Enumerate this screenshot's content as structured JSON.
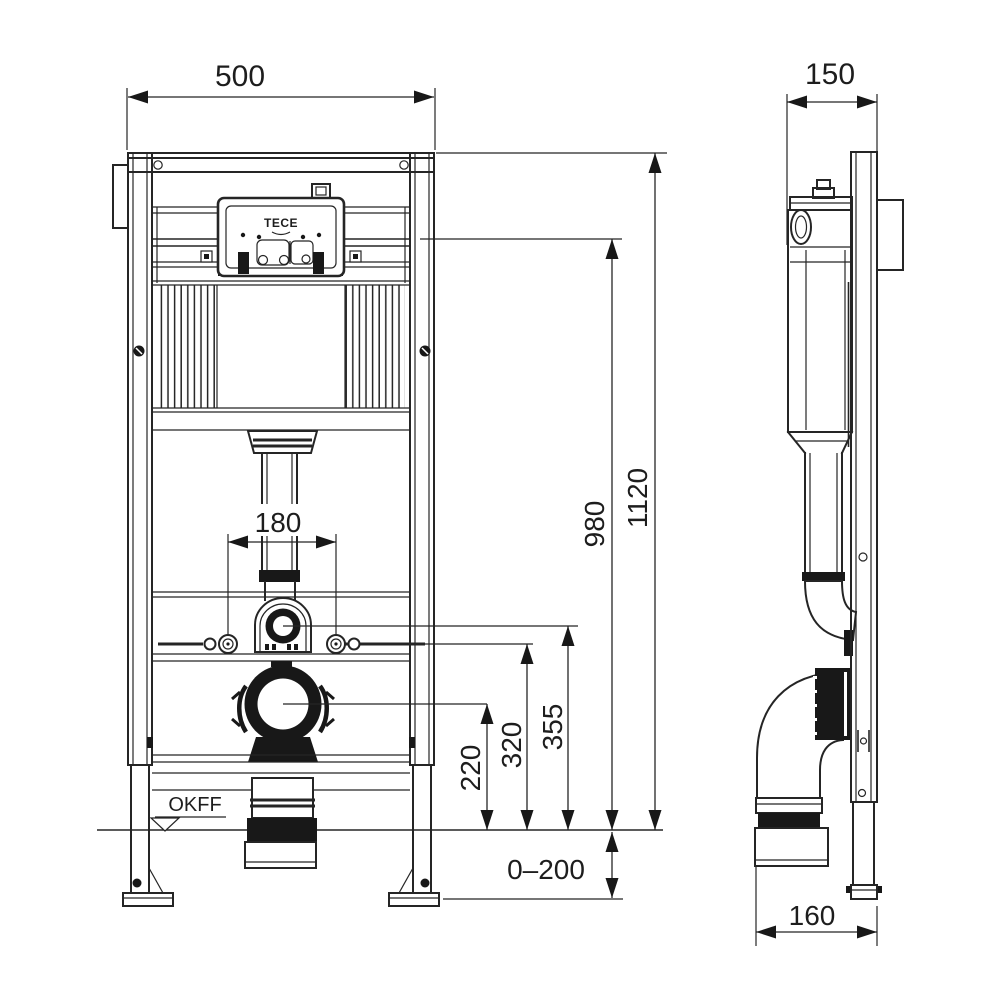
{
  "figure": {
    "type": "technical-drawing",
    "views": [
      {
        "id": "front",
        "name": "front view"
      },
      {
        "id": "side",
        "name": "side view"
      }
    ]
  },
  "dims": {
    "front_width": "500",
    "side_depth": "150",
    "total_height": "1120",
    "upper_height": "980",
    "bolt_spacing": "180",
    "flush_height": "355",
    "bolt_height": "320",
    "outlet_height": "220",
    "floor_buildup": "0–200",
    "outlet_projection": "160"
  },
  "labels": {
    "floor_level": "OKFF",
    "brand": "TECE"
  },
  "colors": {
    "line": "#252525",
    "solid": "#181818",
    "background": "#ffffff"
  }
}
